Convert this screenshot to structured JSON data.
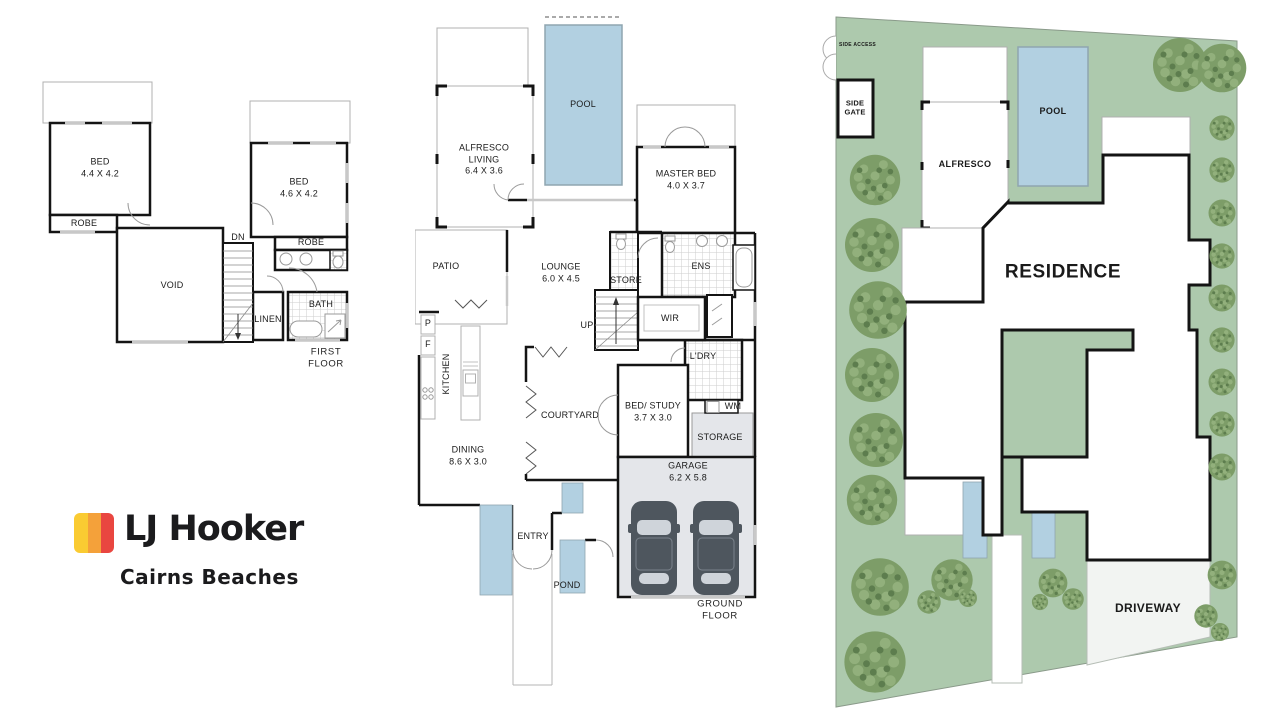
{
  "brand": {
    "name": "LJ Hooker",
    "office": "Cairns Beaches",
    "mark_yellow": "#FACB32",
    "mark_orange": "#F4A13A",
    "mark_red": "#E94640"
  },
  "colors": {
    "pool": "#b2d0e1",
    "pond": "#b2d0e1",
    "lawn": "#adc9ad",
    "paving": "#f2f4f2",
    "garage_floor": "#e4e6ea",
    "car": "#4e565e",
    "tree": "#7d9d68",
    "wall": "#141414"
  },
  "first_floor": {
    "caption": "FIRST FLOOR",
    "rooms": {
      "bed1": "BED\n4.4 X 4.2",
      "robe1": "ROBE",
      "bed2": "BED\n4.6 X 4.2",
      "robe2": "ROBE",
      "void": "VOID",
      "dn": "DN",
      "linen": "LINEN",
      "bath": "BATH"
    }
  },
  "ground_floor": {
    "caption": "GROUND FLOOR",
    "rooms": {
      "alfresco_living": "ALFRESCO\nLIVING\n6.4 X 3.6",
      "pool": "POOL",
      "master_bed": "MASTER BED\n4.0 X 3.7",
      "patio": "PATIO",
      "lounge": "LOUNGE\n6.0 X 4.5",
      "store": "STORE",
      "ens": "ENS",
      "up": "UP",
      "wir": "WIR",
      "pantry": "P",
      "fridge": "F",
      "kitchen": "KITCHEN",
      "courtyard": "COURTYARD",
      "ldry": "L'DRY",
      "bed_study": "BED/ STUDY\n3.7 X 3.0",
      "wm": "WM",
      "storage": "STORAGE",
      "dining": "DINING\n8.6 X 3.0",
      "garage": "GARAGE\n6.2 X 5.8",
      "entry": "ENTRY",
      "pond": "POND"
    }
  },
  "site_plan": {
    "side_access": "SIDE ACCESS",
    "side_gate": "SIDE\nGATE",
    "alfresco": "ALFRESCO",
    "pool": "POOL",
    "residence": "RESIDENCE",
    "driveway": "DRIVEWAY"
  }
}
